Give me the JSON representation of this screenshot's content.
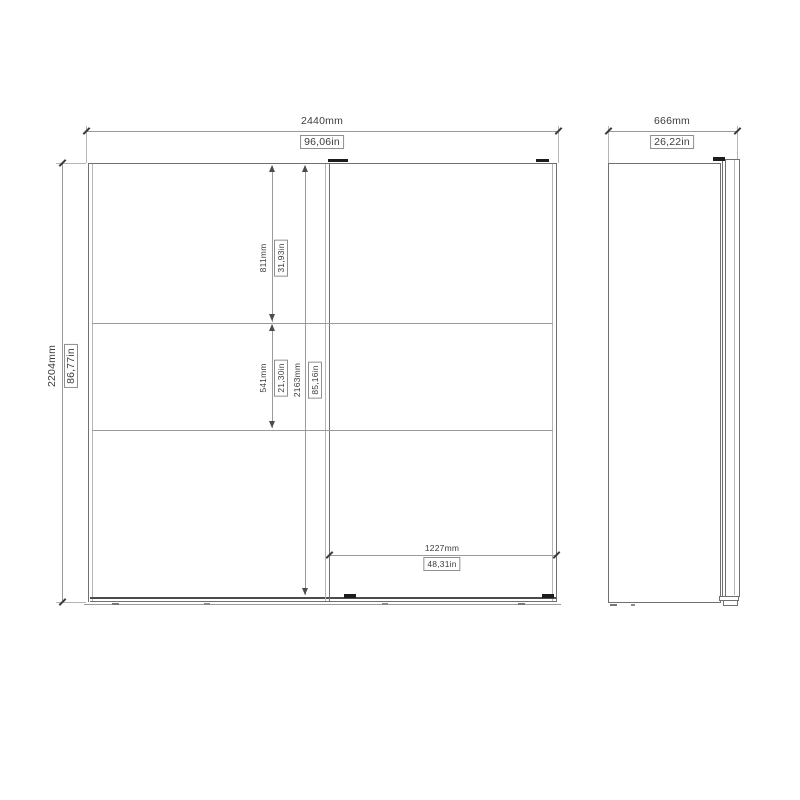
{
  "drawing_type": "wardrobe-technical-dimension-drawing",
  "views": {
    "front": "front-elevation-two-sliding-doors",
    "side": "side-profile"
  },
  "colors": {
    "background": "#ffffff",
    "line": "#9a9a9a",
    "object": "#707070",
    "light": "#b5b5b5",
    "detail": "#1c1c1c",
    "text": "#3c3c3c"
  },
  "dims": {
    "front_width": {
      "mm": "2440mm",
      "in": "96,06in"
    },
    "front_height": {
      "mm": "2204mm",
      "in": "86,77in"
    },
    "top_section": {
      "mm": "811mm",
      "in": "31,93in"
    },
    "middle_section": {
      "mm": "541mm",
      "in": "21,30in"
    },
    "interior_height": {
      "mm": "2163mm",
      "in": "85,16in"
    },
    "door_width": {
      "mm": "1227mm",
      "in": "48,31in"
    },
    "side_depth": {
      "mm": "666mm",
      "in": "26,22in"
    }
  }
}
